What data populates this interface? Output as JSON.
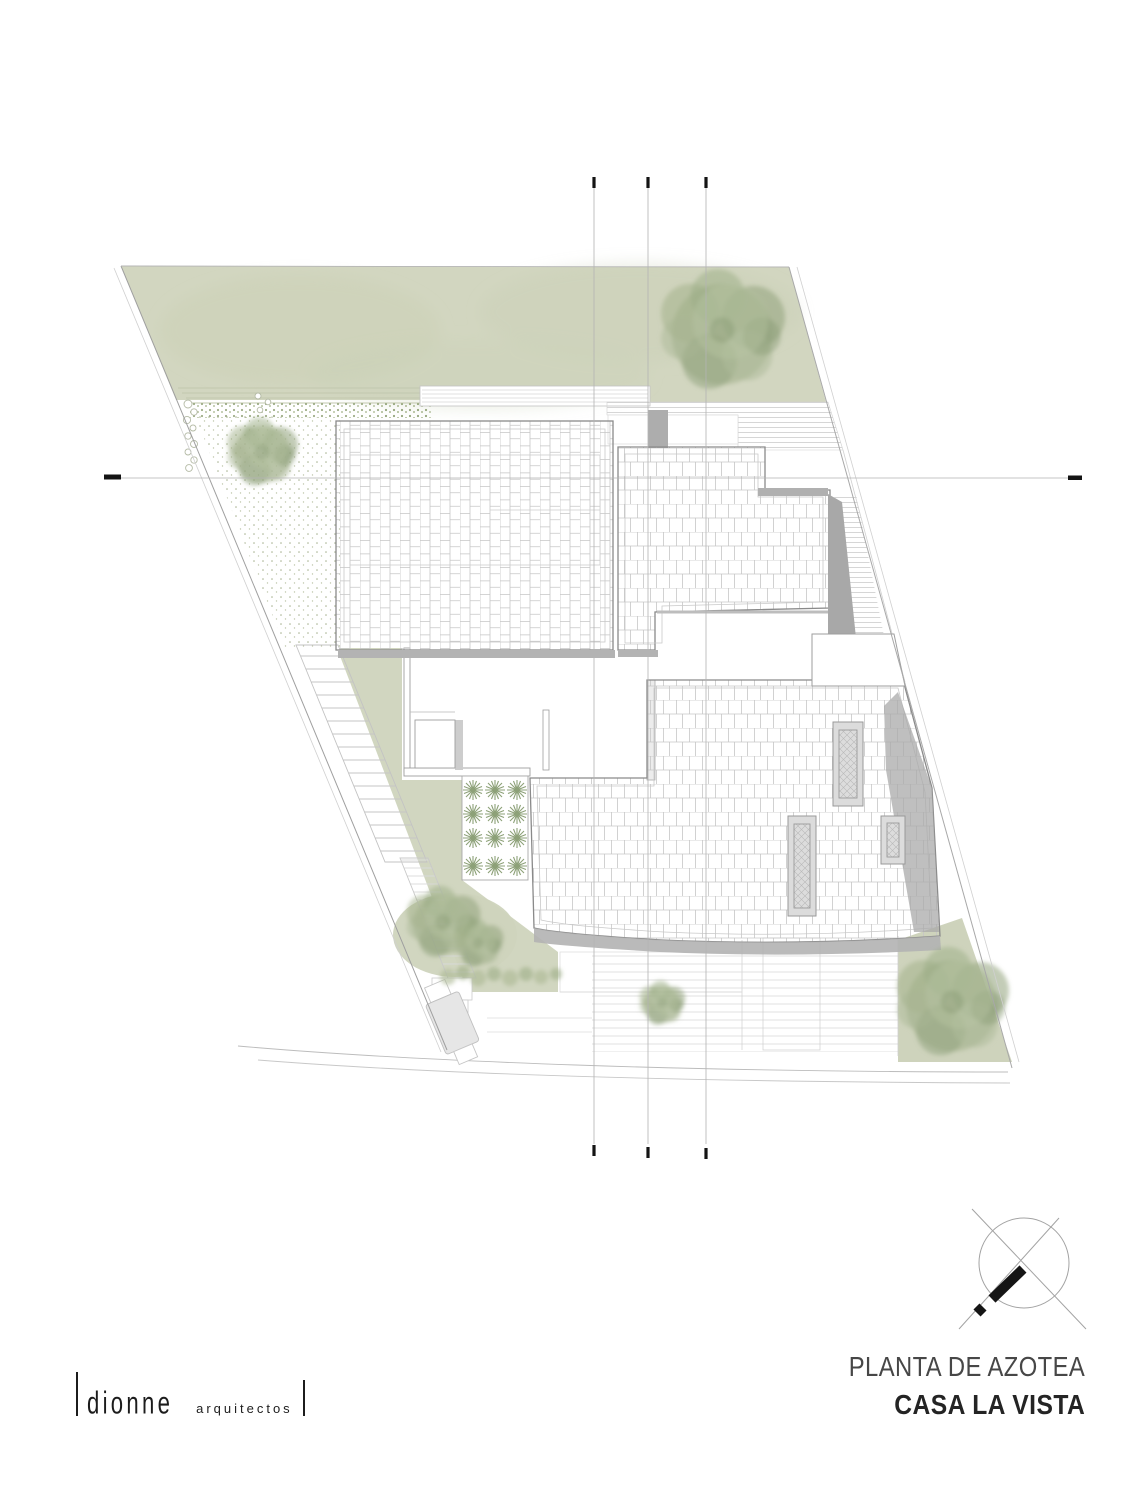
{
  "document": {
    "sheet_title": "PLANTA DE AZOTEA",
    "project_name": "CASA LA VISTA"
  },
  "logo": {
    "brand": "dionne",
    "descriptor": "arquitectos"
  },
  "colors": {
    "lawn": "#d2d6c0",
    "foliage": "#9cab87",
    "hardscape_shadow": "#b0b0b0",
    "outline": "#8f8f8f",
    "tile_grid": "#c6c6c6",
    "axis_line": "#b3b3b3",
    "ink": "#1c1c1c"
  },
  "plan": {
    "type": "roof-plan",
    "elements": [
      "site-boundary",
      "lawn",
      "large-tree-northeast",
      "tree-west",
      "trees-southwest",
      "tree-south",
      "tree-southeast",
      "shrub-row",
      "agave-planter",
      "gravel-path",
      "pebble-edge",
      "side-stairs",
      "main-tiled-roof",
      "upper-east-tiled-roof",
      "lower-tiled-roof",
      "skylight-1",
      "skylight-2",
      "skylight-3",
      "roof-terrace",
      "pergola-strip",
      "deck-hatch-north",
      "deck-hatch-east",
      "driveway",
      "street-edge",
      "entry-gate",
      "structural-axes",
      "north-arrow"
    ]
  }
}
